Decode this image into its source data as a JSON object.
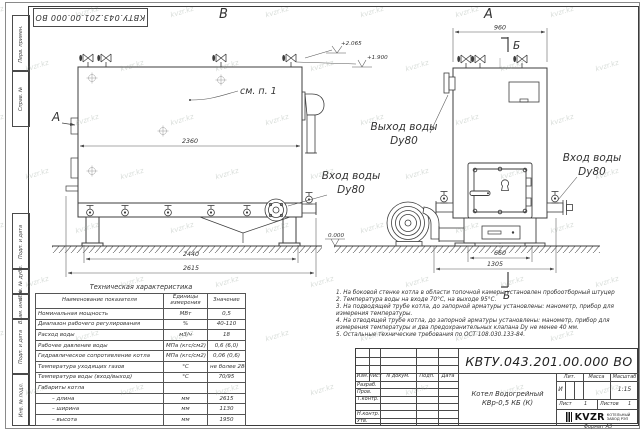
{
  "watermark": {
    "text": "kvzr.kz"
  },
  "frame": {
    "doc_number_top": "КВТУ.043.201.00.000 ВО",
    "side_labels_top": [
      "Перв. примен.",
      "Справ. №"
    ],
    "side_labels_bottom": [
      "Подп. и дата",
      "Инв. № дубл.",
      "Взам. инв. №",
      "Подп. и дата",
      "Инв. № подл."
    ],
    "format_note": "Формат А3"
  },
  "views": {
    "view_b_label": "В",
    "view_a_label": "А",
    "view_a_arrow_label": "А",
    "section_b_top": "Б",
    "section_b_bottom": "Б",
    "see_note": "см. п. 1",
    "elev_top": "+2.065",
    "elev_mid": "+1.900",
    "elev_zero": "0.000",
    "out_label_1": "Выход воды",
    "out_label_2": "Dy80",
    "in_left_1": "Вход воды",
    "in_left_2": "Dy80",
    "in_right_1": "Вход воды",
    "in_right_2": "Dy80",
    "dims": {
      "w_inner": "2360",
      "w_base": "2440",
      "w_total": "2615",
      "a_top": "960",
      "a_door": "660",
      "a_base": "1305"
    }
  },
  "tech_table": {
    "title": "Техническая характеристика",
    "headers": {
      "name": "Наименование показателя",
      "units": "Единицы измерения",
      "value": "Значение"
    },
    "rows": [
      {
        "name": "Номинальная мощность",
        "units": "МВт",
        "value": "0,5"
      },
      {
        "name": "Диапазон рабочего регулирования",
        "units": "%",
        "value": "40-110"
      },
      {
        "name": "Расход воды",
        "units": "м3/ч",
        "value": "18"
      },
      {
        "name": "Рабочее давление воды",
        "units": "МПа (кгс/см2)",
        "value": "0,6 (6,0)"
      },
      {
        "name": "Гидравлическое сопротивление котла",
        "units": "МПа (кгс/см2)",
        "value": "0,06 (0,6)"
      },
      {
        "name": "Температура уходящих газов",
        "units": "°С",
        "value": "не более 280"
      },
      {
        "name": "Температура воды (вход/выход)",
        "units": "°С",
        "value": "70/95"
      },
      {
        "name": "Габариты котла",
        "units": "",
        "value": ""
      },
      {
        "name": "– длина",
        "units": "мм",
        "value": "2615"
      },
      {
        "name": "– ширина",
        "units": "мм",
        "value": "1130"
      },
      {
        "name": "– высота",
        "units": "мм",
        "value": "1950"
      }
    ]
  },
  "notes": {
    "items": [
      "1.  На боковой стенке котла в области топочной камеры установлен пробоотборный штуцер",
      "2.  Температура воды на входе 70°С, на выходе 95°С.",
      "3.  На подводящей трубе котла, до запорной арматуры установлены: манометр, прибор для измерения температуры.",
      "4.  На отводящей трубе котла, до запорной арматуры установлены: манометр, прибор для измерения температуры и два предохранительных клапана Dу не менее 40 мм.",
      "5.  Остальные технические требования по ОСТ 108.030.133-84."
    ]
  },
  "title_block": {
    "doc_number": "КВТУ.043.201.00.000 ВО",
    "header_cols": [
      "Изм.",
      "Лист",
      "N докум.",
      "Подп.",
      "Дата"
    ],
    "row_labels": [
      "Разраб.",
      "Пров.",
      "Т.контр.",
      "",
      "Н.контр.",
      "Утв."
    ],
    "product_name_1": "Котел Водогрейный",
    "product_name_2": "КВр-0,5 КБ (К)",
    "lit_header": "Лит.",
    "mass_header": "Масса",
    "scale_header": "Масштаб",
    "lit_value": "И",
    "scale_value": "1:15",
    "sheet_label": "Лист",
    "sheet_value": "1",
    "sheets_label": "Листов",
    "sheets_value": "1",
    "logo_text": "KVZR",
    "company_line1": "КОТЕЛЬНЫЙ",
    "company_line2": "ЗАВОД РЭП"
  }
}
